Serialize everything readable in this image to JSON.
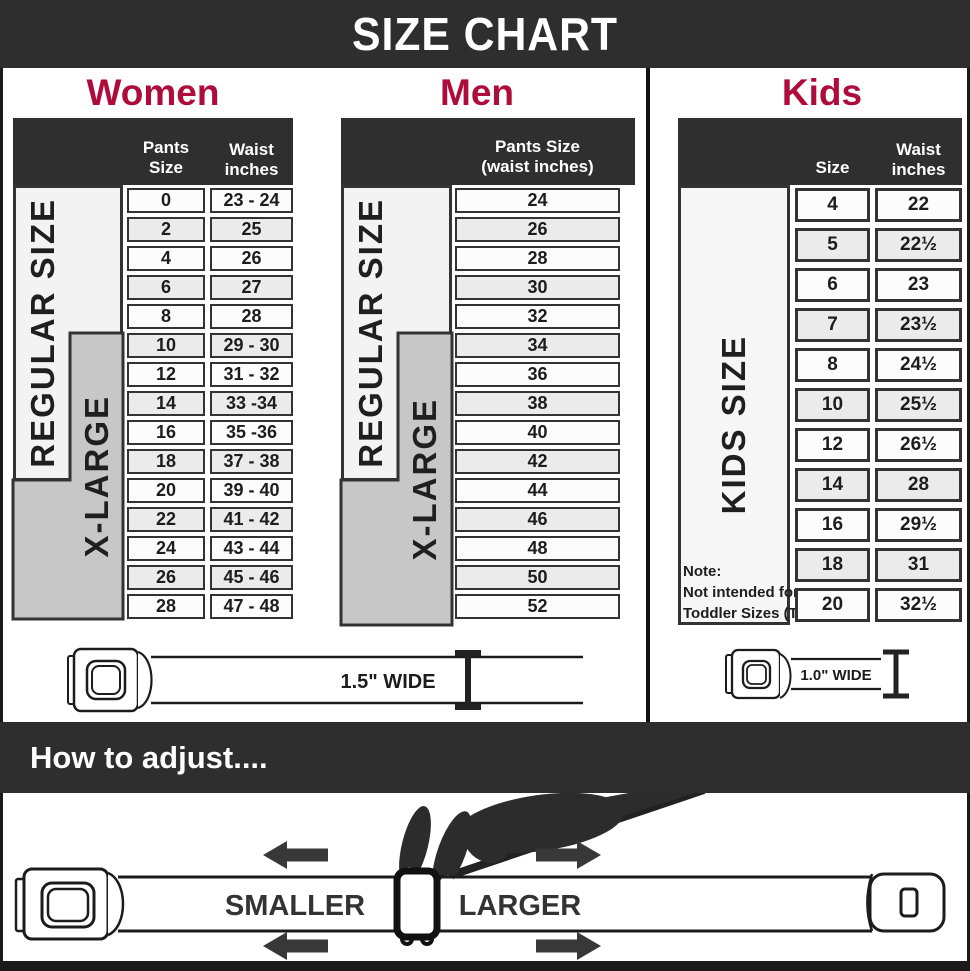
{
  "title": "SIZE CHART",
  "colors": {
    "banner_dark": "#2e2e2e",
    "accent_crimson": "#ae0c3b",
    "xlarge_gray": "#c7c7c7",
    "cell_border": "#333333"
  },
  "women": {
    "heading": "Women",
    "col1_header": "Pants Size",
    "col2_header_line1": "Waist",
    "col2_header_line2": "inches",
    "regular_label": "REGULAR SIZE",
    "xlarge_label": "X-LARGE",
    "rows": [
      {
        "size": "0",
        "waist": "23 - 24"
      },
      {
        "size": "2",
        "waist": "25"
      },
      {
        "size": "4",
        "waist": "26"
      },
      {
        "size": "6",
        "waist": "27"
      },
      {
        "size": "8",
        "waist": "28"
      },
      {
        "size": "10",
        "waist": "29 - 30"
      },
      {
        "size": "12",
        "waist": "31 - 32"
      },
      {
        "size": "14",
        "waist": "33 -34"
      },
      {
        "size": "16",
        "waist": "35 -36"
      },
      {
        "size": "18",
        "waist": "37 - 38"
      },
      {
        "size": "20",
        "waist": "39 - 40"
      },
      {
        "size": "22",
        "waist": "41 - 42"
      },
      {
        "size": "24",
        "waist": "43 - 44"
      },
      {
        "size": "26",
        "waist": "45 - 46"
      },
      {
        "size": "28",
        "waist": "47 - 48"
      }
    ]
  },
  "men": {
    "heading": "Men",
    "header_line1": "Pants Size",
    "header_line2": "(waist inches)",
    "regular_label": "REGULAR SIZE",
    "xlarge_label": "X-LARGE",
    "rows": [
      "24",
      "26",
      "28",
      "30",
      "32",
      "34",
      "36",
      "38",
      "40",
      "42",
      "44",
      "46",
      "48",
      "50",
      "52"
    ]
  },
  "kids": {
    "heading": "Kids",
    "col1_header": "Size",
    "col2_header_line1": "Waist",
    "col2_header_line2": "inches",
    "size_label": "KIDS SIZE",
    "note_line1": "Note:",
    "note_line2": "Not intended for",
    "note_line3": "Toddler Sizes (T)",
    "rows": [
      {
        "size": "4",
        "waist": "22"
      },
      {
        "size": "5",
        "waist": "22½"
      },
      {
        "size": "6",
        "waist": "23"
      },
      {
        "size": "7",
        "waist": "23½"
      },
      {
        "size": "8",
        "waist": "24½"
      },
      {
        "size": "10",
        "waist": "25½"
      },
      {
        "size": "12",
        "waist": "26½"
      },
      {
        "size": "14",
        "waist": "28"
      },
      {
        "size": "16",
        "waist": "29½"
      },
      {
        "size": "18",
        "waist": "31"
      },
      {
        "size": "20",
        "waist": "32½"
      }
    ]
  },
  "belts": {
    "adult_width_label": "1.5\" WIDE",
    "kids_width_label": "1.0\" WIDE"
  },
  "adjust": {
    "heading": "How to adjust....",
    "smaller_label": "SMALLER",
    "larger_label": "LARGER"
  }
}
